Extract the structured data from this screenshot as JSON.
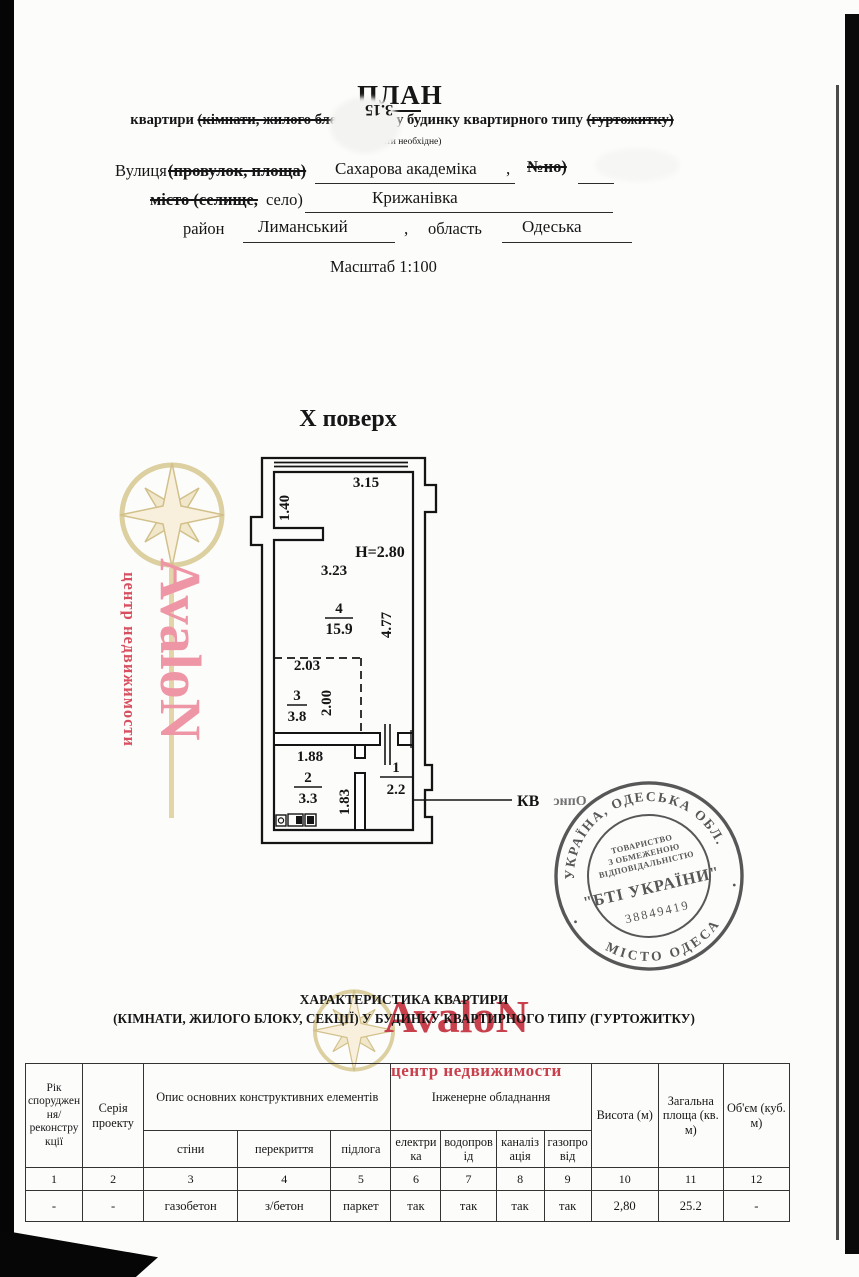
{
  "header": {
    "title_underlined": "ПЛА",
    "title_rest": "Н",
    "bleed_number": "3.15",
    "subtitle_pre": "квартири ",
    "subtitle_struck_1": "(кімнати, жилого блоку, секці",
    "subtitle_mid": "  у будинку квартирного типу ",
    "subtitle_struck_2": "(гуртожитку)",
    "note": "(вказати необхідне)"
  },
  "address": {
    "street_label": "Вулиця",
    "street_label_struck": "(провулок, площа)",
    "street_value": "Сахарова академіка",
    "comma": ",",
    "number_struck": "№но)",
    "city_struck": "місто (селище,",
    "city_label": "село)",
    "city_value": "Крижанівка",
    "district_label": "район",
    "district_value": "Лиманський",
    "region_label": "область",
    "region_value": "Одеська",
    "scale": "Масштаб 1:100"
  },
  "plan": {
    "floor": "Х поверх",
    "ceiling_height": "H=2.80",
    "dim_top": "3.15",
    "dim_niche": "1.40",
    "dim_room4_w": "3.23",
    "dim_room4_h": "4.77",
    "dim_room3_w": "2.03",
    "dim_room3_h": "2.00",
    "dim_room2_w": "1.88",
    "dim_room2_h": "1.83",
    "room4_num": "4",
    "room4_area": "15.9",
    "room3_num": "3",
    "room3_area": "3.8",
    "room2_num": "2",
    "room2_area": "3.3",
    "room1_num": "1",
    "room1_area": "2.2",
    "kv_label": "КВ",
    "bleed_text": "Опис"
  },
  "watermark": {
    "brand": "AvaloN",
    "tagline": "центр недвижимости",
    "pink": "#ee96a5",
    "red": "#c9404d",
    "gold": "#dccfa0"
  },
  "stamp": {
    "arc_top": "УКРАЇНА, ОДЕСЬКА ОБЛ.",
    "arc_bottom": "МІСТО ОДЕСА",
    "org_line1": "ТОВАРИСТВО",
    "org_line2": "З ОБМЕЖЕНОЮ",
    "org_line3": "ВІДПОВІДАЛЬНІСТЮ",
    "org_name": "\"БТІ УКРАЇНИ\"",
    "code": "38849419",
    "ink": "#4a4a4a",
    "dot": "•"
  },
  "table": {
    "heading_line1": "ХАРАКТЕРИСТИКА КВАРТИРИ",
    "heading_line2": "(КІМНАТИ, ЖИЛОГО БЛОКУ, СЕКЦІЇ) У БУДИНКУ КВАРТИРНОГО ТИПУ (ГУРТОЖИТКУ)",
    "headers": {
      "year": "Рік спорудження/ реконструкції",
      "series": "Серія проекту",
      "construction_group": "Опис основних конструктивних елементів",
      "walls": "стіни",
      "slabs": "перекриття",
      "floor": "підлога",
      "utilities_group": "Інженерне обладнання",
      "electricity": "електрика",
      "water": "водопровід",
      "sewage": "каналізація",
      "gas": "газопровід",
      "height": "Висота (м)",
      "total_area": "Загальна площа (кв. м)",
      "volume": "Об'єм (куб. м)"
    },
    "numbers": [
      "1",
      "2",
      "3",
      "4",
      "5",
      "6",
      "7",
      "8",
      "9",
      "10",
      "11",
      "12"
    ],
    "values": [
      "-",
      "-",
      "газобетон",
      "з/бетон",
      "паркет",
      "так",
      "так",
      "так",
      "так",
      "2,80",
      "25.2",
      "-"
    ]
  }
}
